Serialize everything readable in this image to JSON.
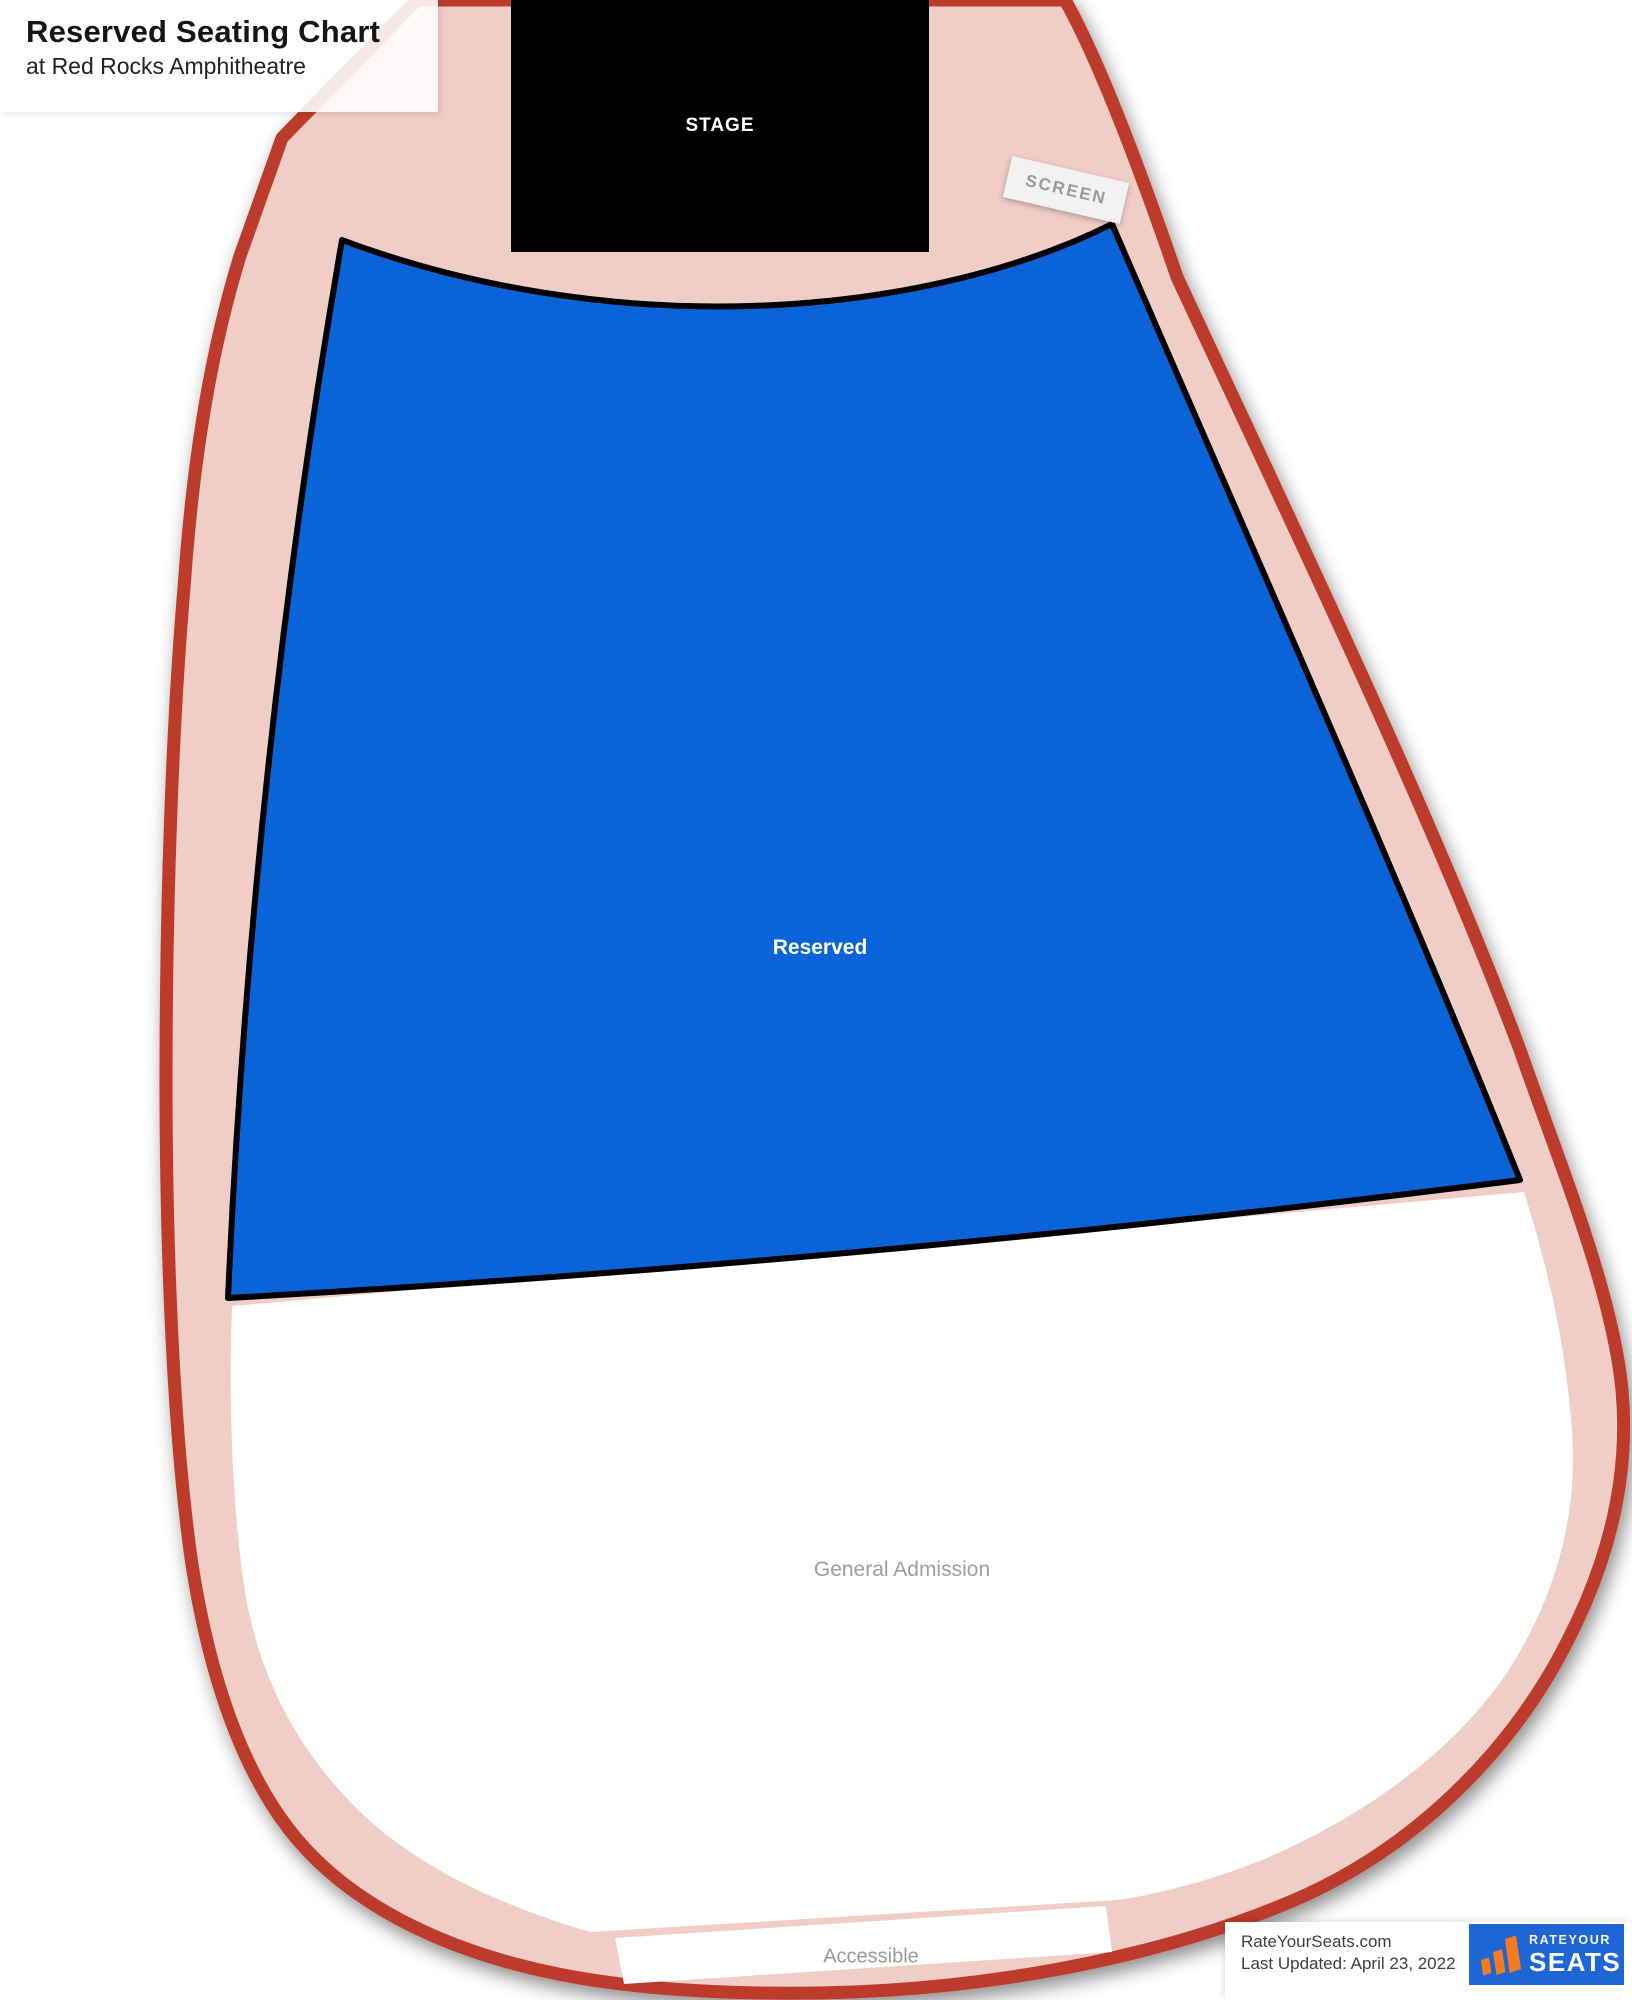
{
  "header": {
    "title": "Reserved Seating Chart",
    "subtitle": "at Red Rocks Amphitheatre"
  },
  "stage": {
    "label": "STAGE"
  },
  "screen": {
    "label": "SCREEN"
  },
  "sections": {
    "reserved": {
      "label": "Reserved"
    },
    "general_admission": {
      "label": "General Admission"
    },
    "accessible": {
      "label": "Accessible"
    }
  },
  "footer": {
    "site": "RateYourSeats.com",
    "last_updated": "Last Updated: April 23, 2022"
  },
  "logo": {
    "brand_top": "RATEYOUR",
    "brand_main": "SEATS",
    "brand_suffix": "com"
  },
  "colors": {
    "outline_red": "#bd3a29",
    "walkway_pink": "#f0cdc5",
    "reserved_blue": "#0a64d8",
    "stage_black": "#000000",
    "logo_blue": "#1e66d3",
    "logo_orange": "#f47b20",
    "label_gray": "#9e9e9e"
  }
}
